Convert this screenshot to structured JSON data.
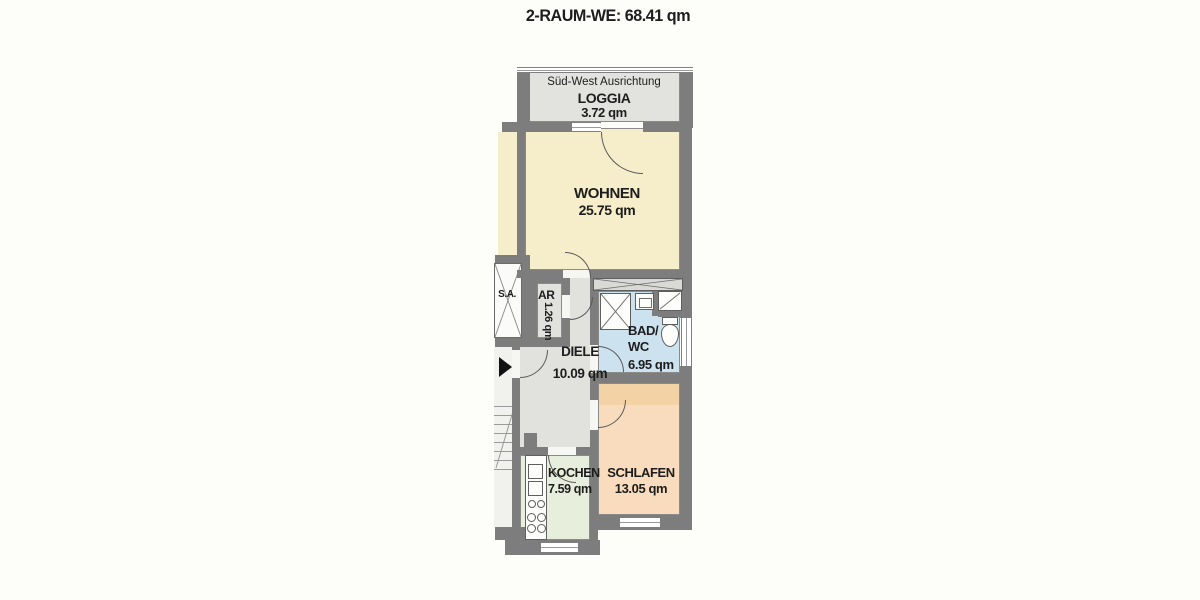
{
  "title": "2-RAUM-WE: 68.41 qm",
  "orientation_label": "Süd-West Ausrichtung",
  "elevator_label": "S.A.",
  "rooms": {
    "loggia": {
      "name": "LOGGIA",
      "area": "3.72 qm",
      "fill": "#e2e2de"
    },
    "wohnen": {
      "name": "WOHNEN",
      "area": "25.75 qm",
      "fill": "#f6eecb"
    },
    "ar": {
      "name": "AR",
      "area": "1.26 qm",
      "fill": "#e1e1dd"
    },
    "bad": {
      "name": "BAD/\nWC",
      "area": "6.95 qm",
      "fill": "#cde2ef"
    },
    "diele": {
      "name": "DIELE",
      "area": "10.09 qm",
      "fill": "#e1e1dd"
    },
    "kochen": {
      "name": "KOCHEN",
      "area": "7.59 qm",
      "fill": "#e7eedb"
    },
    "schlafen": {
      "name": "SCHLAFEN",
      "area": "13.05 qm",
      "fill": "#f8dcbd",
      "fill_top": "#f3d3a5"
    }
  },
  "colors": {
    "wall": "#7d7d7d",
    "line": "#5a5a5a",
    "bg": "#fdfdfa",
    "text": "#1d1d1d",
    "stairwell": "#f1f1ee"
  }
}
